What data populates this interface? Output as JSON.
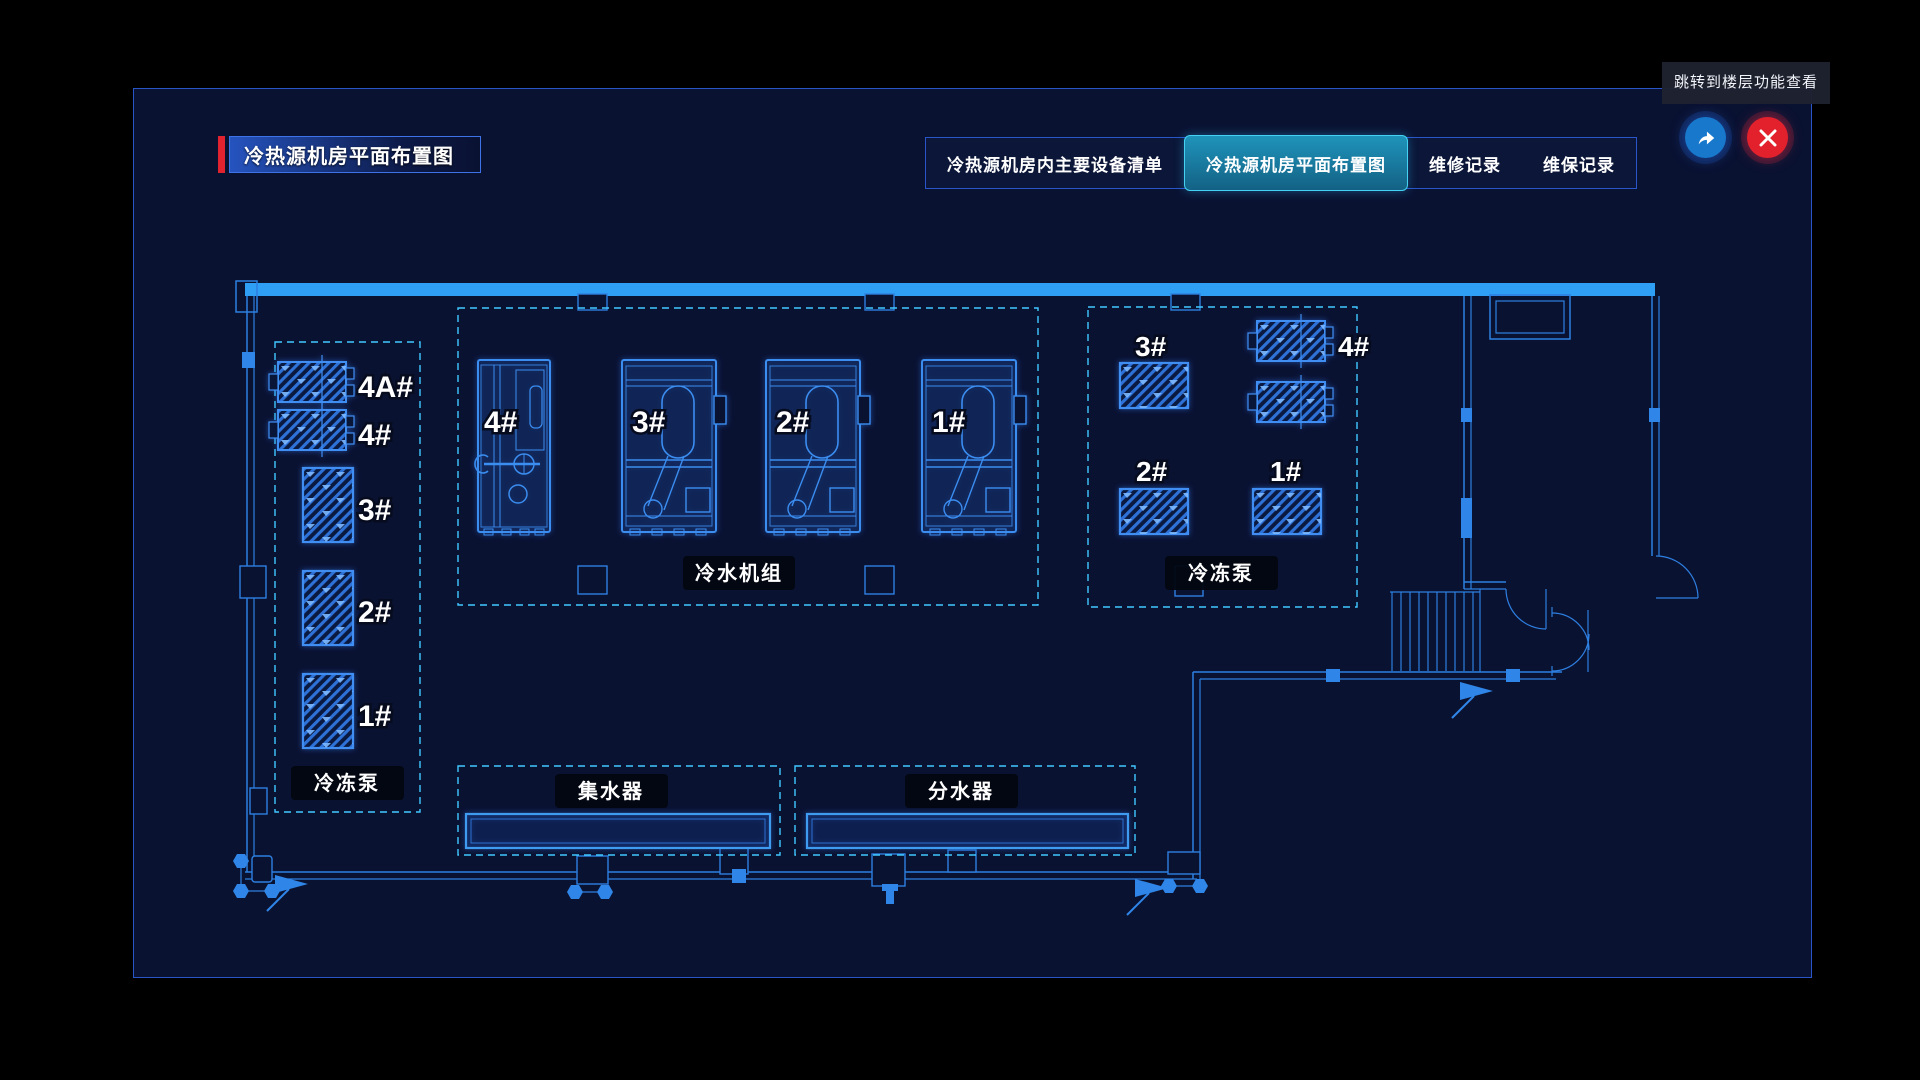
{
  "colors": {
    "accent_red": "#e0232e",
    "panel_border": "#2a55c8",
    "active_tab": "#1783a8",
    "plan_blue": "#3b8df0",
    "dashed_cyan": "#41c9ff",
    "wall_blue": "#2f9ef5",
    "jump_button": "#1778cc",
    "close_button": "#e3212d"
  },
  "header": {
    "title": "冷热源机房平面布置图"
  },
  "tabs": [
    {
      "label": "冷热源机房内主要设备清单",
      "active": false
    },
    {
      "label": "冷热源机房平面布置图",
      "active": true
    },
    {
      "label": "维修记录",
      "active": false
    },
    {
      "label": "维保记录",
      "active": false
    }
  ],
  "tooltip": {
    "text": "跳转到楼层功能查看"
  },
  "plan": {
    "left_pumps": {
      "group_label": "冷冻泵",
      "units": {
        "u4a": "4A#",
        "u4": "4#",
        "u3": "3#",
        "u2": "2#",
        "u1": "1#"
      }
    },
    "chillers": {
      "group_label": "冷水机组",
      "units": {
        "u4": "4#",
        "u3": "3#",
        "u2": "2#",
        "u1": "1#"
      }
    },
    "right_pumps": {
      "group_label": "冷冻泵",
      "units": {
        "u3": "3#",
        "u4": "4#",
        "u2": "2#",
        "u1": "1#"
      }
    },
    "collector": {
      "label": "集水器"
    },
    "distributor": {
      "label": "分水器"
    }
  }
}
